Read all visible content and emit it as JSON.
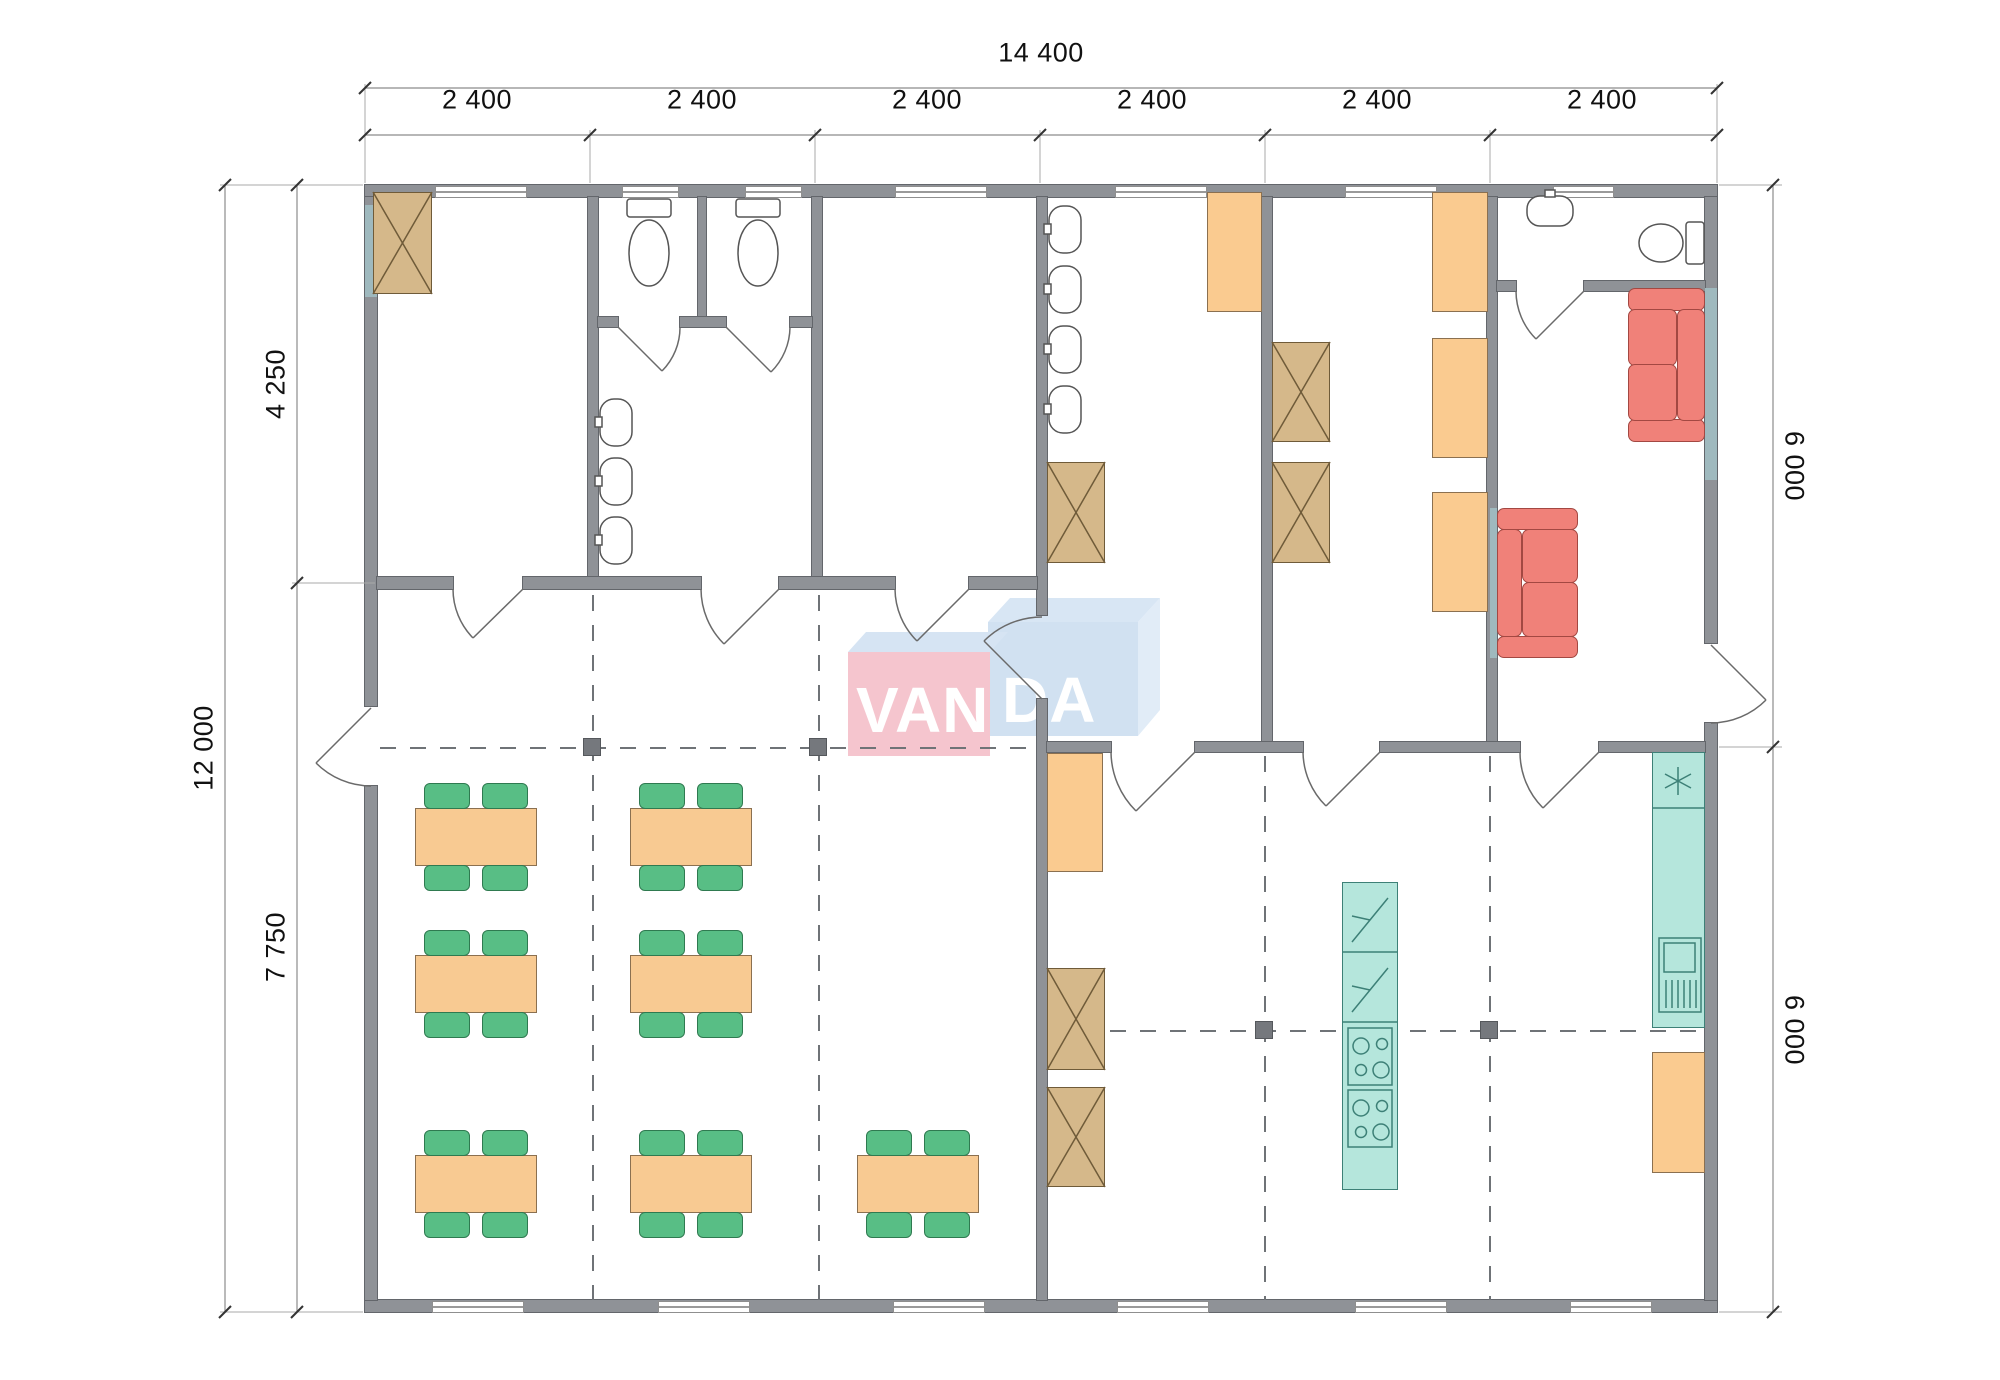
{
  "watermark": {
    "text": "VANDA",
    "part1": "VAN",
    "part2": "DA"
  },
  "dimensions": {
    "top": {
      "total": "14 400",
      "segments": [
        "2 400",
        "2 400",
        "2 400",
        "2 400",
        "2 400",
        "2 400"
      ]
    },
    "left": {
      "total": "12 000",
      "segments": [
        "4 250",
        "7 750"
      ]
    },
    "right": {
      "segments": [
        "6 000",
        "6 000"
      ]
    }
  },
  "palette": {
    "wall": "#8F9297",
    "table": "#F8CA92",
    "chair": "#58BE85",
    "wardrobe": "#D5B88A",
    "cabinet": "#FACB90",
    "sofa": "#F08179",
    "kitchen_unit": "#B5E6DC",
    "glass_strip": "#9FB9BE",
    "logo_pink": "#F4BCC6",
    "logo_blue": "#C9DCEF",
    "logo_text": "#FFFFFF"
  },
  "legend": {
    "dining_tables": 7,
    "chairs": 28,
    "wardrobes": 6,
    "storage_cabinets": 6,
    "sofas": 2,
    "toilets": 3,
    "washbasins": 8,
    "cooktops": 2,
    "kitchen_appliances": 2,
    "fridge_freezer": 1,
    "kitchen_sink_units": 1
  }
}
